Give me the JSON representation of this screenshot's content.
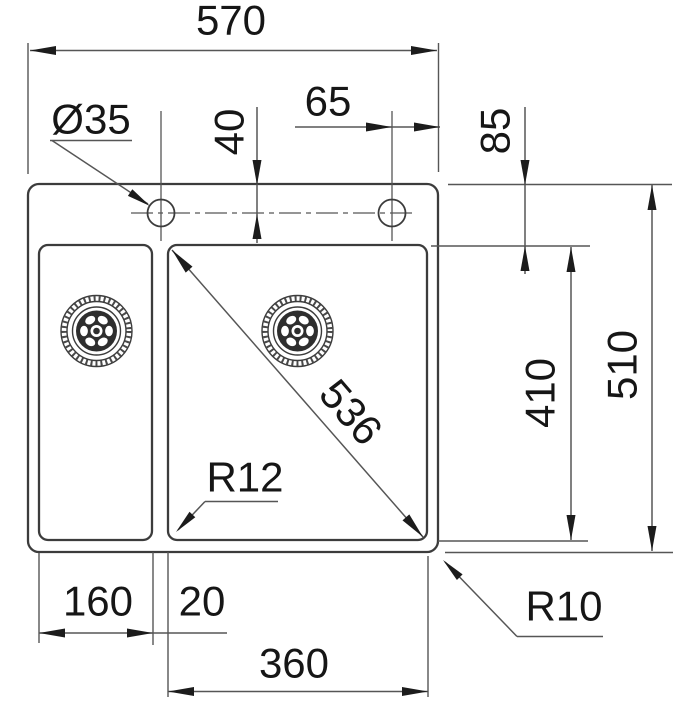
{
  "title": "Sink cut-out technical drawing",
  "colors": {
    "outline": "#3c3c3c",
    "line": "#565656",
    "arrow": "#1c1c1c",
    "text": "#161616",
    "bg": "#ffffff",
    "drain": "#2e2e2e"
  },
  "drawing": {
    "dimensions": {
      "overall_width": "570",
      "hole_diameter": "Ø35",
      "hole_offset_top": "40",
      "hole_offset_right": "65",
      "rim_to_bowl": "85",
      "bowl_diagonal": "536",
      "bowl_depth": "410",
      "overall_depth": "510",
      "bowl_corner_radius": "R12",
      "outer_corner_radius": "R10",
      "left_bowl_width": "160",
      "bowl_gap": "20",
      "right_bowl_width": "360"
    }
  }
}
